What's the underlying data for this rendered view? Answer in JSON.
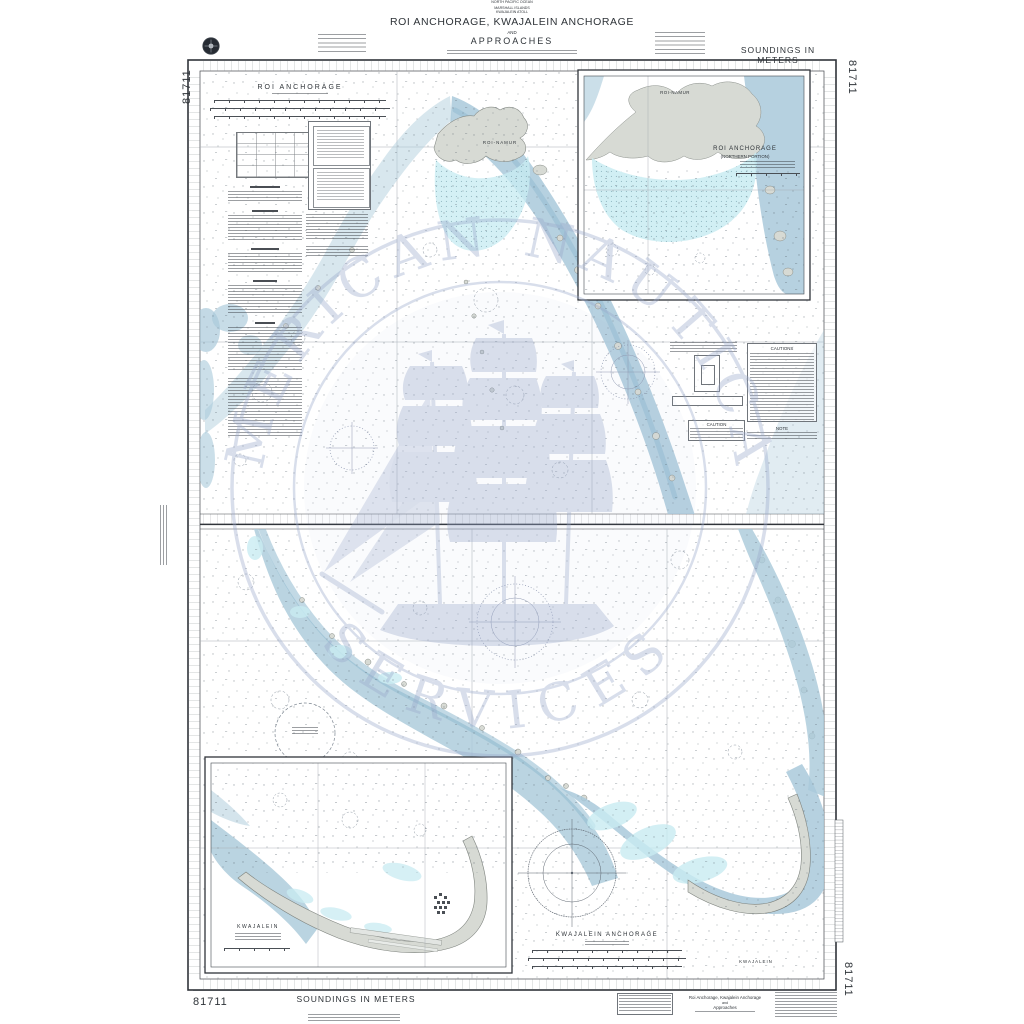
{
  "chart_number": "81711",
  "header": {
    "region_lines": [
      "NORTH PACIFIC OCEAN",
      "MARSHALL ISLANDS",
      "KWAJALEIN ATOLL"
    ],
    "title": "ROI ANCHORAGE, KWAJALEIN ANCHORAGE",
    "conjunction": "AND",
    "subtitle": "APPROACHES",
    "soundings_note": "SOUNDINGS IN METERS"
  },
  "footer": {
    "soundings_note": "SOUNDINGS IN METERS",
    "title_block": [
      "Roi Anchorage, Kwajalein Anchorage",
      "and",
      "Approaches"
    ]
  },
  "map_labels": {
    "roi_plan_title": "ROI ANCHORAGE",
    "roi_namur_main": "ROI-NAMUR",
    "inset_roi_title": "ROI ANCHORAGE",
    "inset_roi_subtitle": "(NORTHERN PORTION)",
    "inset_roi_island": "ROI-NAMUR",
    "kwajalein_anchorage_title": "KWAJALEIN ANCHORAGE",
    "kwajalein_island": "KWAJALEIN",
    "inset_kwajalein_title": "KWAJALEIN",
    "cautions_title": "CAUTIONS",
    "note_title": "NOTE",
    "caution_title": "CAUTION"
  },
  "watermark": {
    "arc_top": "AMERICAN NAUTICAL",
    "arc_bottom": "SERVICES"
  },
  "colors": {
    "water_deep": "#a9c9da",
    "water_channel": "#8fb9cf",
    "shallow": "#c9ecf2",
    "land": "#d7dad4",
    "watermark": "#9aa9cb",
    "ink": "#3a3f45"
  }
}
